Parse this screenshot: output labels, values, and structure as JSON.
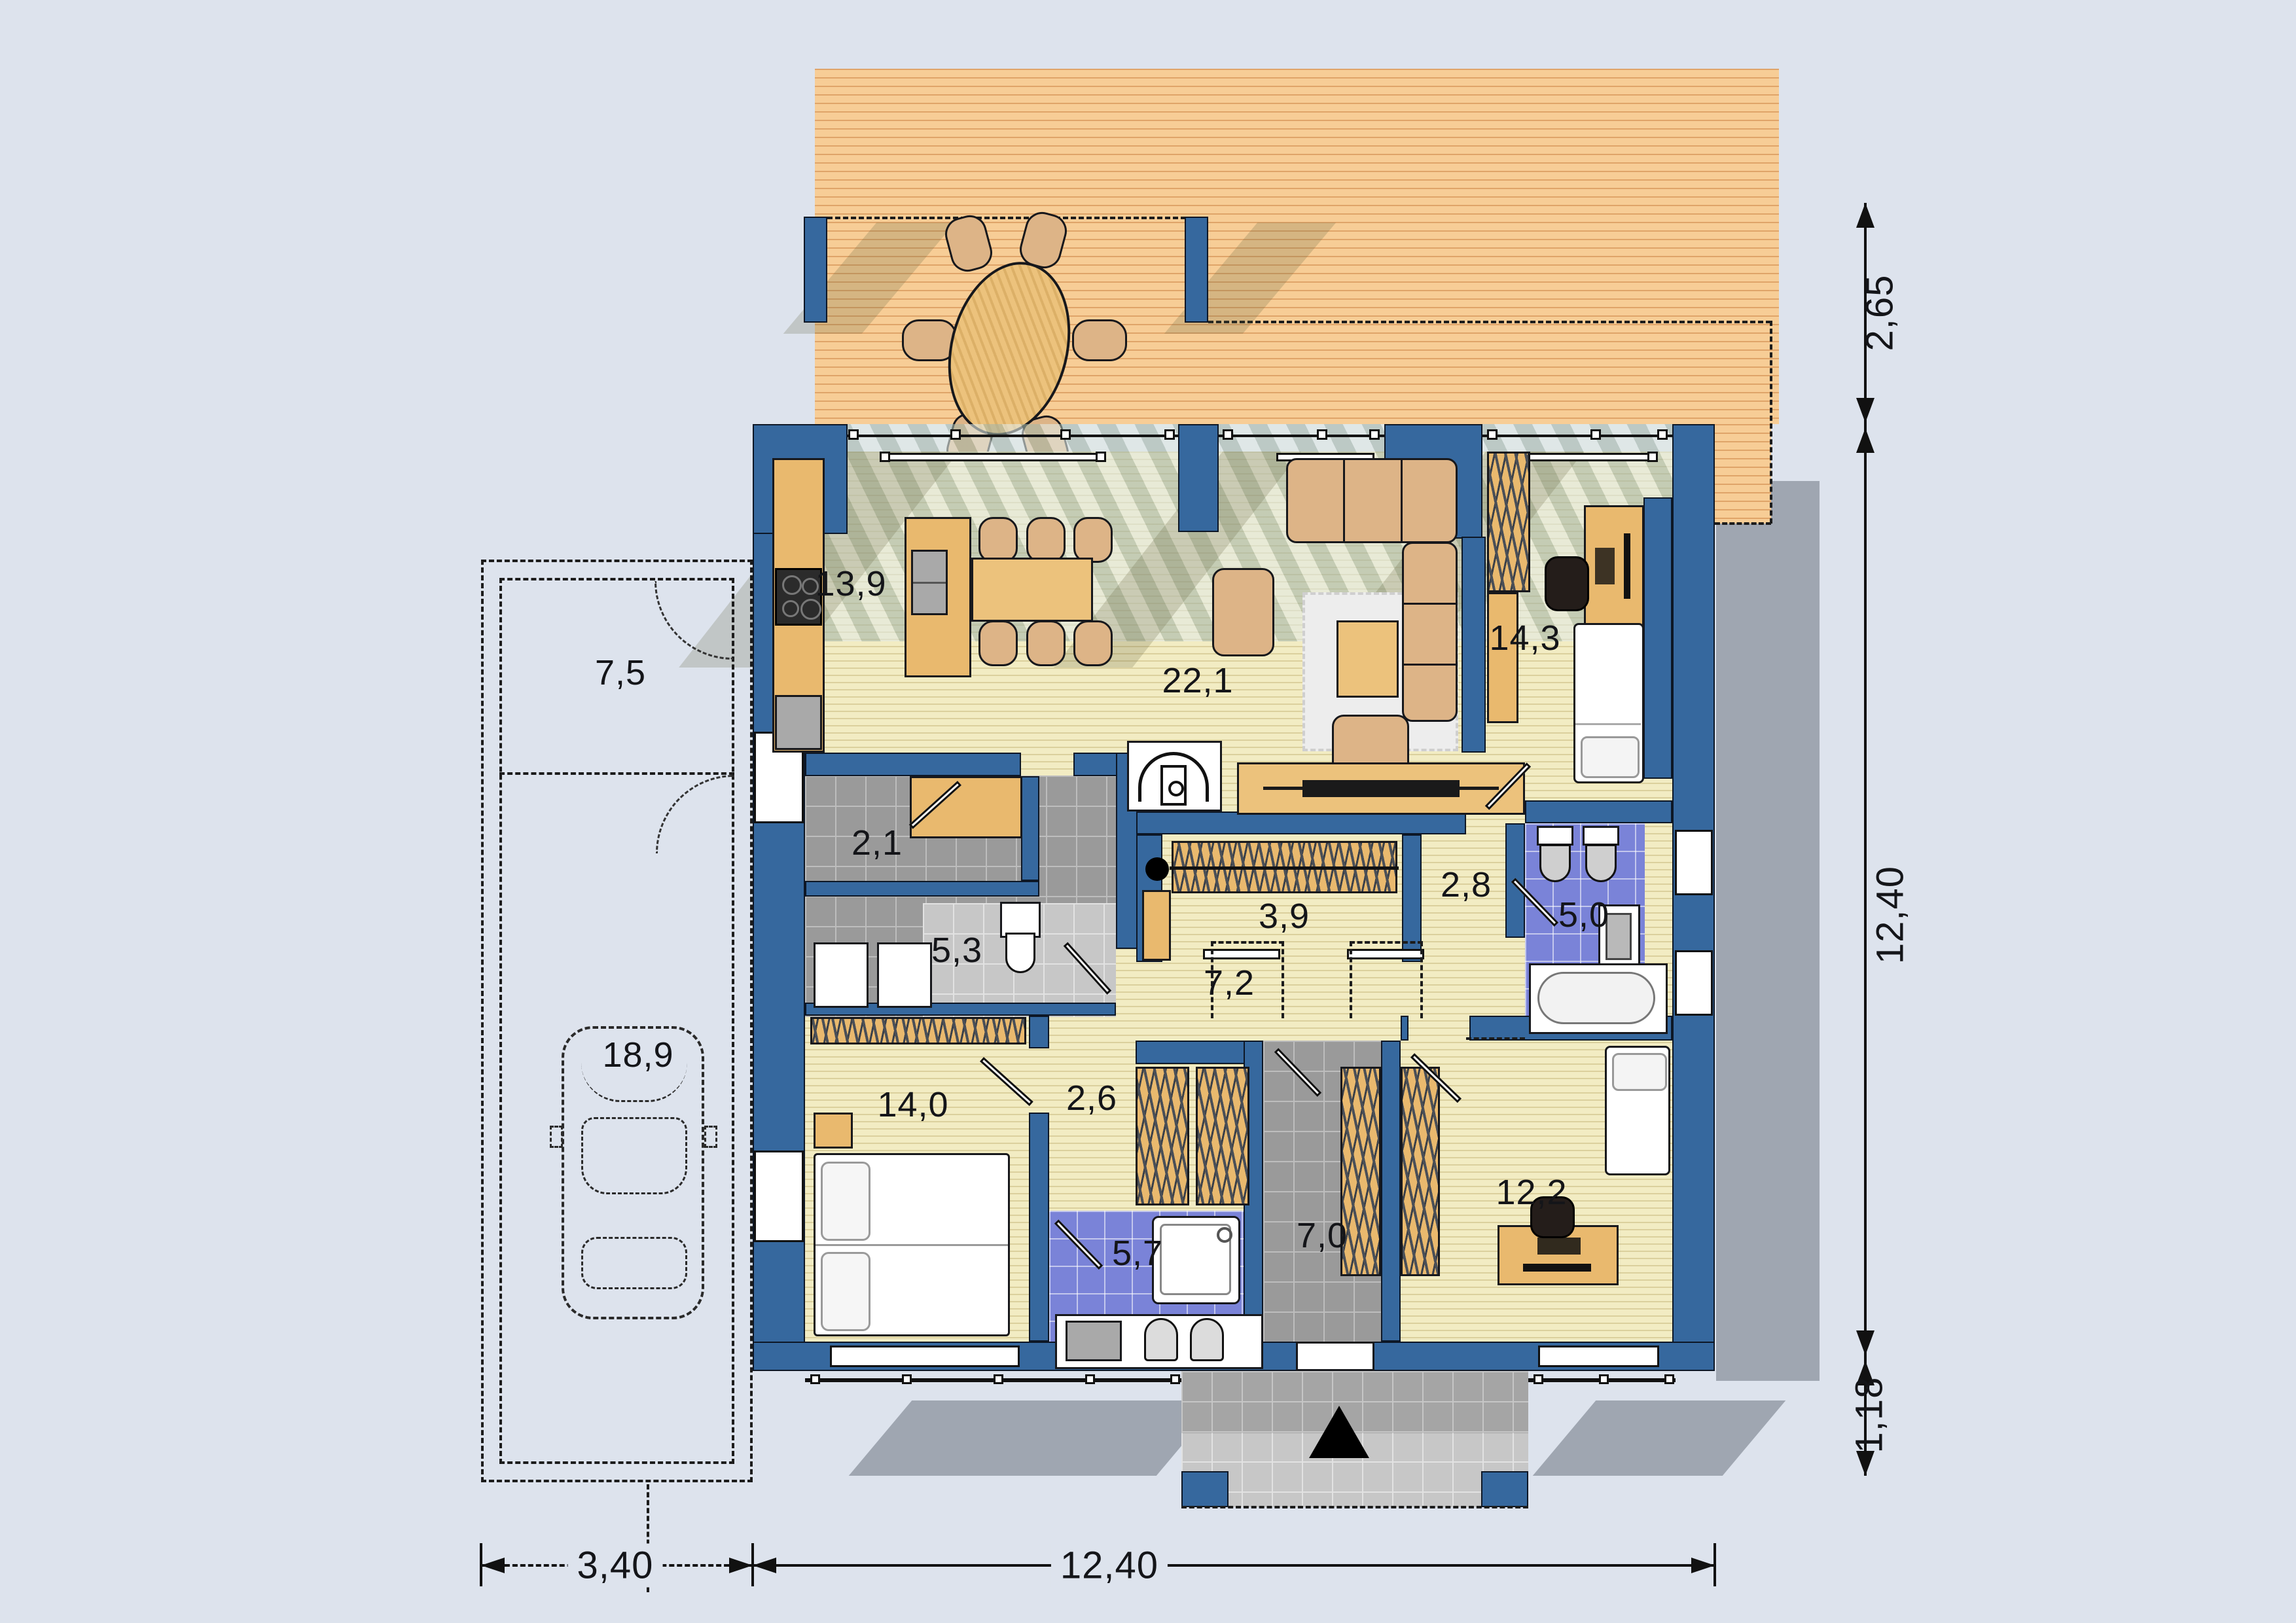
{
  "plan_title": "single-storey house floor plan",
  "palette": {
    "wall_blue": "#36689e",
    "wood_floor": "#f2ecc3",
    "terrace_wood": "#f7cd96",
    "tile_gray": "#9a9a9a",
    "tile_blue": "#7a83d8",
    "furniture_tan": "#e9b96e",
    "background": "#dde3ed"
  },
  "rooms": {
    "kitchen": {
      "area": "13,9"
    },
    "living_room": {
      "area": "22,1"
    },
    "bedroom_top_right": {
      "area": "14,3"
    },
    "pantry": {
      "area": "2,1"
    },
    "utility_room": {
      "area": "5,3"
    },
    "walk_in_closet": {
      "area": "3,9"
    },
    "small_hall": {
      "area": "2,8"
    },
    "bathroom_top": {
      "area": "5,0"
    },
    "corridor": {
      "area": "7,2"
    },
    "wardrobe_hall": {
      "area": "2,6"
    },
    "bedroom_left": {
      "area": "14,0"
    },
    "bathroom_bottom": {
      "area": "5,7"
    },
    "entry_hall": {
      "area": "7,0"
    },
    "bedroom_bottom_right": {
      "area": "12,2"
    },
    "garage": {
      "area": "18,9"
    },
    "garage_storage": {
      "area": "7,5"
    }
  },
  "dimensions": {
    "right_top": "2,65",
    "right_main": "12,40",
    "right_bottom": "1,18",
    "bottom_garage": "3,40",
    "bottom_house": "12,40"
  },
  "icons": {
    "entrance_marker": "entrance-triangle",
    "fireplace": "stove-fireplace",
    "north_car": "car-outline"
  }
}
